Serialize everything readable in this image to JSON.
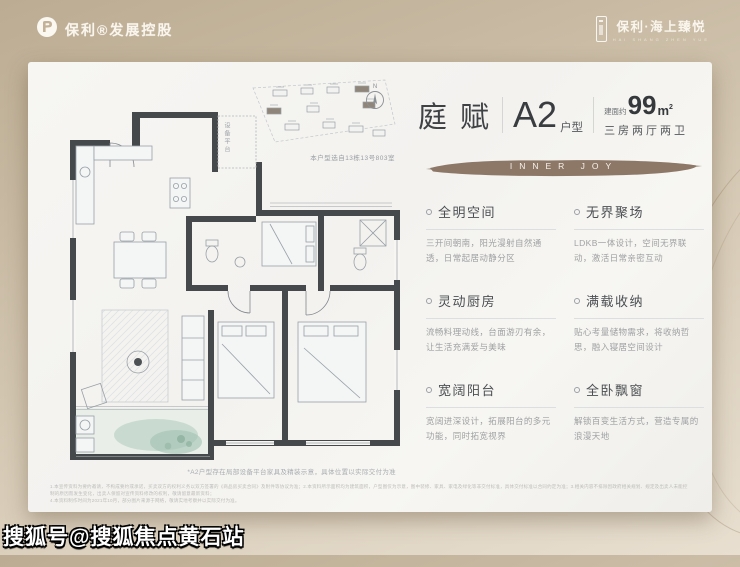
{
  "header": {
    "left_logo_text": "保利®发展控股",
    "right_logo_title": "保利·海上臻悦",
    "right_logo_sub": "HAI SHANG ZHEN YUE"
  },
  "card": {
    "title": {
      "name": "庭赋",
      "type_big": "A2",
      "type_small": "户型",
      "area_prefix": "建面约",
      "area_num": "99",
      "area_unit_base": "m",
      "area_unit_sup": "2",
      "rooms": "三房两厅两卫"
    },
    "banner": {
      "text": "INNER JOY",
      "color": "#8d7767"
    },
    "features": [
      {
        "title": "全明空间",
        "desc": "三开间朝南，阳光漫射自然通透，日常起居动静分区"
      },
      {
        "title": "无界聚场",
        "desc": "LDKB一体设计，空间无界联动，激活日常亲密互动"
      },
      {
        "title": "灵动厨房",
        "desc": "流畅料理动线，台面游刃有余，让生活充满爱与美味"
      },
      {
        "title": "满载收纳",
        "desc": "贴心考量储物需求，将收纳哲思，融入寝居空间设计"
      },
      {
        "title": "宽阔阳台",
        "desc": "宽阔进深设计，拓展阳台的多元功能，同时拓宽视界"
      },
      {
        "title": "全卧飘窗",
        "desc": "解锁百变生活方式，营造专属的浪漫天地"
      }
    ],
    "plan": {
      "device_platform_label": "设备平台",
      "compass_label": "N",
      "site_caption": "本户型选自13栋13号803室",
      "footnote": "*A2户型存在局部设备平台家具及精装示意，具体位置以实际交付为准"
    },
    "disclaimer_line1": "1.本宣传资料为要约邀请，不构成要约或承诺，买卖双方的权利义务以双方签署的《商品房买卖合同》及附件等协议为准；2.本资料所示面积均为建筑面积，户型图仅为示意，图中装修、家具、家电及绿化等非交付标准，具体交付标准以合同约定为准；3.相关内容不排除因政府相关规划、规定及出卖人未能控制的原因而发生变化，出卖人保留对宣传资料修改的权利，敬请留意最新资料；",
    "disclaimer_line2": "4.本资料制作时间为2021年10月，部分图片来源于网络，敬请实地考察并以实际交付为准。"
  },
  "watermark": {
    "text": "搜狐号@搜狐焦点黄石站"
  }
}
